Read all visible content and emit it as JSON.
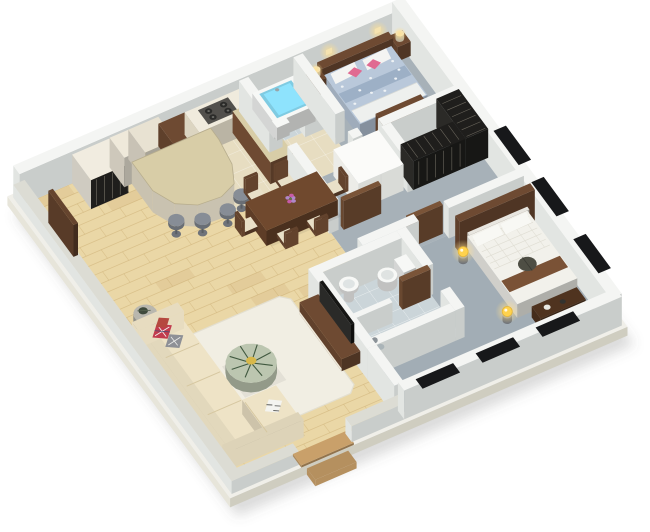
{
  "colors": {
    "background": "#ffffff",
    "shadow": "rgba(90,95,95,0.22)",
    "slabTop": "#f0efe9",
    "slabSide": "#e7e5da",
    "slabEdge": "#cfcdc0",
    "wallTop": "#f4f5f3",
    "wallSW": "#e2e5e2",
    "wallSE": "#c9cdcb",
    "wallLowTop": "#dcdcd4",
    "wood": "#ead7a6",
    "woodLine": "#cdb076",
    "woodVar": "rgba(185,143,82,0.14)",
    "kitchenFloor": "#e7ddc1",
    "carpet": "#a7b1b8",
    "carpetMaster": "#a2adb5",
    "carpetDark": "#96a1a9",
    "tile": "#cbd5d9",
    "grout": "rgba(255,255,255,0.65)",
    "tubBlue": "#7fcbe2",
    "fixtureWhite": "#f7f8f6",
    "cream": "#efe7d2",
    "tallCab": "#efe9da",
    "fridge": "#e8e2d2",
    "counterTop": "#f0ebdd",
    "granite": "#d8cda7",
    "walnut": "#6e4a32",
    "walnutDark": "#4f331f",
    "door": "#7a5438",
    "black": "#1f1e1c",
    "stripe": "#6b675d",
    "steel": "#8f959d",
    "stoolSeat": "#878d96",
    "sofa": "#eee3c6",
    "rug": "#f1eee3",
    "rugEdge": "#e3dfd0",
    "greenTable": "#bcc6b0",
    "plant": "#40583f",
    "lamp": "#ffd24d",
    "glow": "#ffdf8e",
    "bedFloral": "#b9c8da",
    "bedFloralDark": "#9db0c6",
    "bedFoot": "#eef0ee",
    "pink": "#e06a92",
    "red": "#c23b4e",
    "gray": "#8e9096",
    "bedWhite": "#f2f1eb",
    "bedTexture": "#e0ded4",
    "runner": "#7a5236",
    "darkItem": "#4e4e44",
    "builtin": "#fbfbf9",
    "thresh": "#c9a06a",
    "tv": "#161614",
    "cooktop": "#52504c",
    "burner": "#2b2b29",
    "sconce": "#f5e3b0",
    "window": "#17181a"
  },
  "scene": {
    "view": "isometric-3d-floor-plan",
    "rooms": [
      {
        "name": "living-room",
        "floor": "wood"
      },
      {
        "name": "dining-area",
        "floor": "wood"
      },
      {
        "name": "kitchen",
        "floor": "beige-tile"
      },
      {
        "name": "hallway",
        "floor": "gray-carpet"
      },
      {
        "name": "bedroom-small",
        "floor": "gray-carpet"
      },
      {
        "name": "bathroom-tub",
        "floor": "light-tile"
      },
      {
        "name": "bedroom-master",
        "floor": "gray-carpet"
      },
      {
        "name": "bathroom-ensuite",
        "floor": "light-tile"
      },
      {
        "name": "wardrobe-niche",
        "floor": "gray-carpet"
      }
    ],
    "furniture": [
      "corner-sofa",
      "throw-pillows",
      "area-rug",
      "coffee-table",
      "plant-centerpiece",
      "side-table",
      "dining-table",
      "dining-chairs",
      "flower-vase",
      "breakfast-bar",
      "bar-stools",
      "kitchen-counter",
      "cooktop",
      "refrigerator",
      "open-shelves",
      "tall-cabinet",
      "entry-closet",
      "wall-tv-panel",
      "bathtub",
      "small-basin",
      "double-bed-floral",
      "nightstands",
      "table-lamps",
      "dresser",
      "wall-sconces",
      "black-wardrobe",
      "white-built-in",
      "interior-doors",
      "tv-console",
      "television",
      "toilet",
      "pedestal-sink",
      "shower",
      "shower-partition",
      "double-bed-white",
      "glow-lamps",
      "foot-bench",
      "headboard-panel",
      "windows",
      "entrance-threshold",
      "entrance-step"
    ]
  }
}
